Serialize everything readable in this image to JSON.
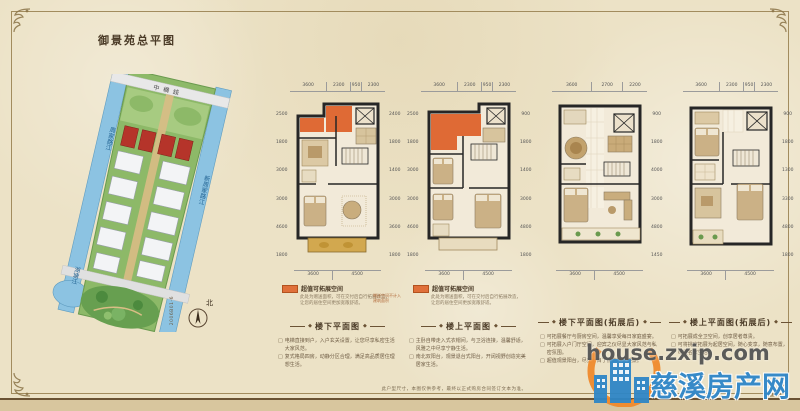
{
  "page": {
    "title": "御景苑总平图",
    "disclaimer": "此户型尺寸，本图仅供参考，最终以正式购房合同签订文本为准。",
    "bullet_prefix": "□",
    "ornament": "◆",
    "background_color": "#ece2c6",
    "frame_color": "#a28c5e"
  },
  "site_plan": {
    "road_top": "中横线",
    "river_left": "周家路江",
    "river_right": "新周家路江",
    "river_bottom": "湖塘江",
    "north_label": "北",
    "drawing_code": "2006B01-6"
  },
  "legend": {
    "label": "超值可拓展空间",
    "note_line1": "此处为赠送面积，可在交付后自行拓展改造，",
    "note_line2": "让您的居住空间更加宽敞舒适。",
    "color": "#e0703a"
  },
  "plans": [
    {
      "title": "楼下平面图",
      "dims_top": [
        "3600",
        "2300",
        "950",
        "2300"
      ],
      "dims_bottom": [
        "3600",
        "4500"
      ],
      "dims_left": [
        "2500",
        "1800",
        "3000",
        "3000",
        "4600",
        "1800"
      ],
      "dims_right": [
        "2400",
        "1800",
        "1400",
        "3000",
        "3600",
        "1800"
      ],
      "annotation": "赠送空间不计入建筑面积",
      "bullets": [
        "电梯直接到户，入户玄关设置，让您尽享私密生活大家风范。",
        "复式格局四房，动静分区合理，满足高品质居住理想生活。"
      ]
    },
    {
      "title": "楼上平面图",
      "dims_top": [
        "3600",
        "2300",
        "950",
        "2300"
      ],
      "dims_bottom": [
        "3600",
        "4500"
      ],
      "dims_left": [
        "2500",
        "1800",
        "3000",
        "3000",
        "4600",
        "1800"
      ],
      "dims_right": [
        "900",
        "1800",
        "1400",
        "3000",
        "4800",
        "1800"
      ],
      "bullets": [
        "主卧自带走入式衣帽间，与卫浴连接，温馨舒适，风雅之中尽享宁静生活。",
        "南北双阳台，观景退台式阳台，开阔视野创造完美居家生活。"
      ]
    },
    {
      "title": "楼下平面图(拓展后)",
      "dims_top": [
        "3600",
        "2700",
        "2200"
      ],
      "dims_bottom": [
        "3600",
        "4500"
      ],
      "dims_right": [
        "900",
        "1800",
        "4000",
        "3000",
        "4800",
        "1450"
      ],
      "bullets": [
        "可拓展餐厅与厨房空间，温馨享受每日家庭盛宴。",
        "可拓展入户门厅空间，迎宾之仪尽显大家风范与私密氛围。",
        "超值观景阳台，尽览一目了然的社区美景。"
      ]
    },
    {
      "title": "楼上平面图(拓展后)",
      "dims_top": [
        "3600",
        "2300",
        "950",
        "2300"
      ],
      "dims_bottom": [
        "3600",
        "4500"
      ],
      "dims_right": [
        "900",
        "1800",
        "1300",
        "3300",
        "4800",
        "1800"
      ],
      "bullets": [
        "可拓展成全卫空间，创享居者尊贵。",
        "可将挑空拓展为起居空间，随心变享，随意布置，尽显名家生活。"
      ]
    }
  ],
  "watermark": {
    "url": "house.zxip.com",
    "site_name": "慈溪房产网",
    "brand_blue": "#2e86c9",
    "brand_orange": "#f08a2d"
  }
}
